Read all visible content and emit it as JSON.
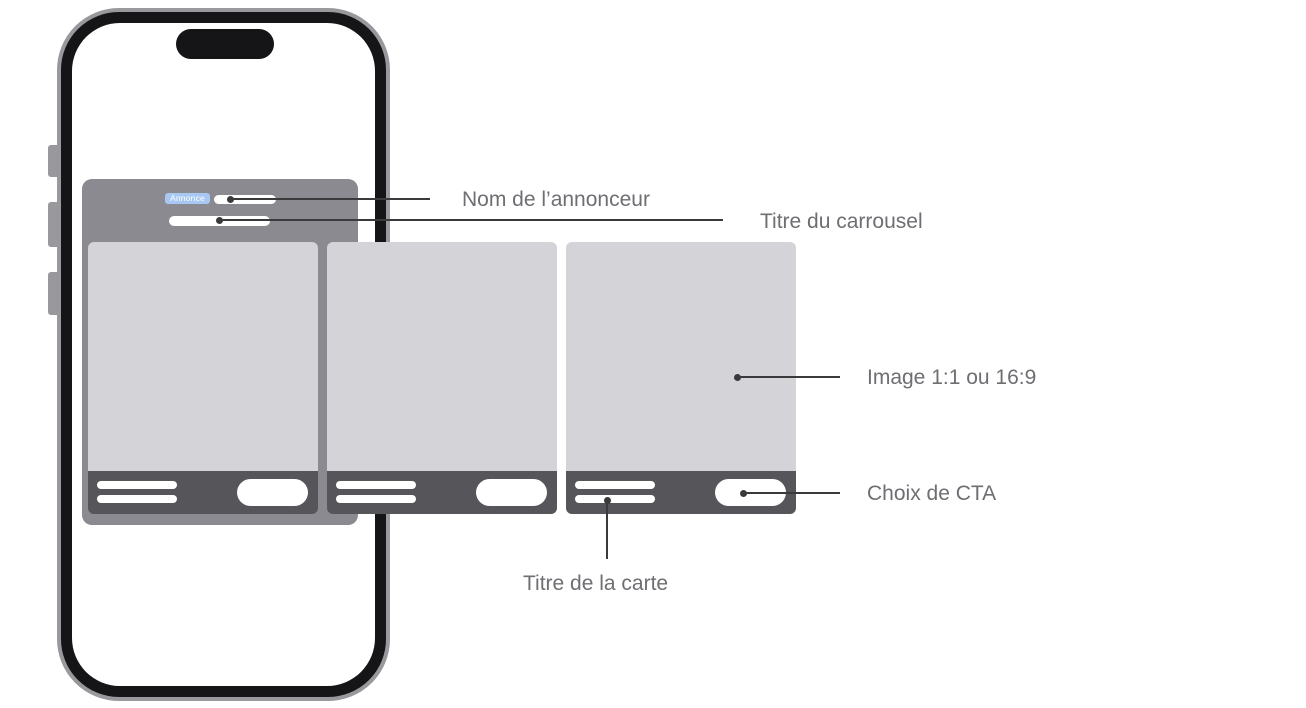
{
  "ad_mockup": {
    "badge_label": "Annonce"
  },
  "annotations": {
    "advertiser_name": "Nom de l’annonceur",
    "carousel_title": "Titre du carrousel",
    "image_ratio": "Image 1:1 ou 16:9",
    "cta_choice": "Choix de CTA",
    "card_title": "Titre de la carte"
  },
  "colors": {
    "ad_badge_blue": "#A6C8F3",
    "panel_gray": "#8A8A90",
    "card_image_gray": "#D3D3D8",
    "cta_bar_gray": "#56565A",
    "annotation_text": "#6E6E73",
    "leader_line": "#3A3A3C",
    "phone_frame_black": "#151517",
    "phone_rim_gray": "#98989D"
  }
}
